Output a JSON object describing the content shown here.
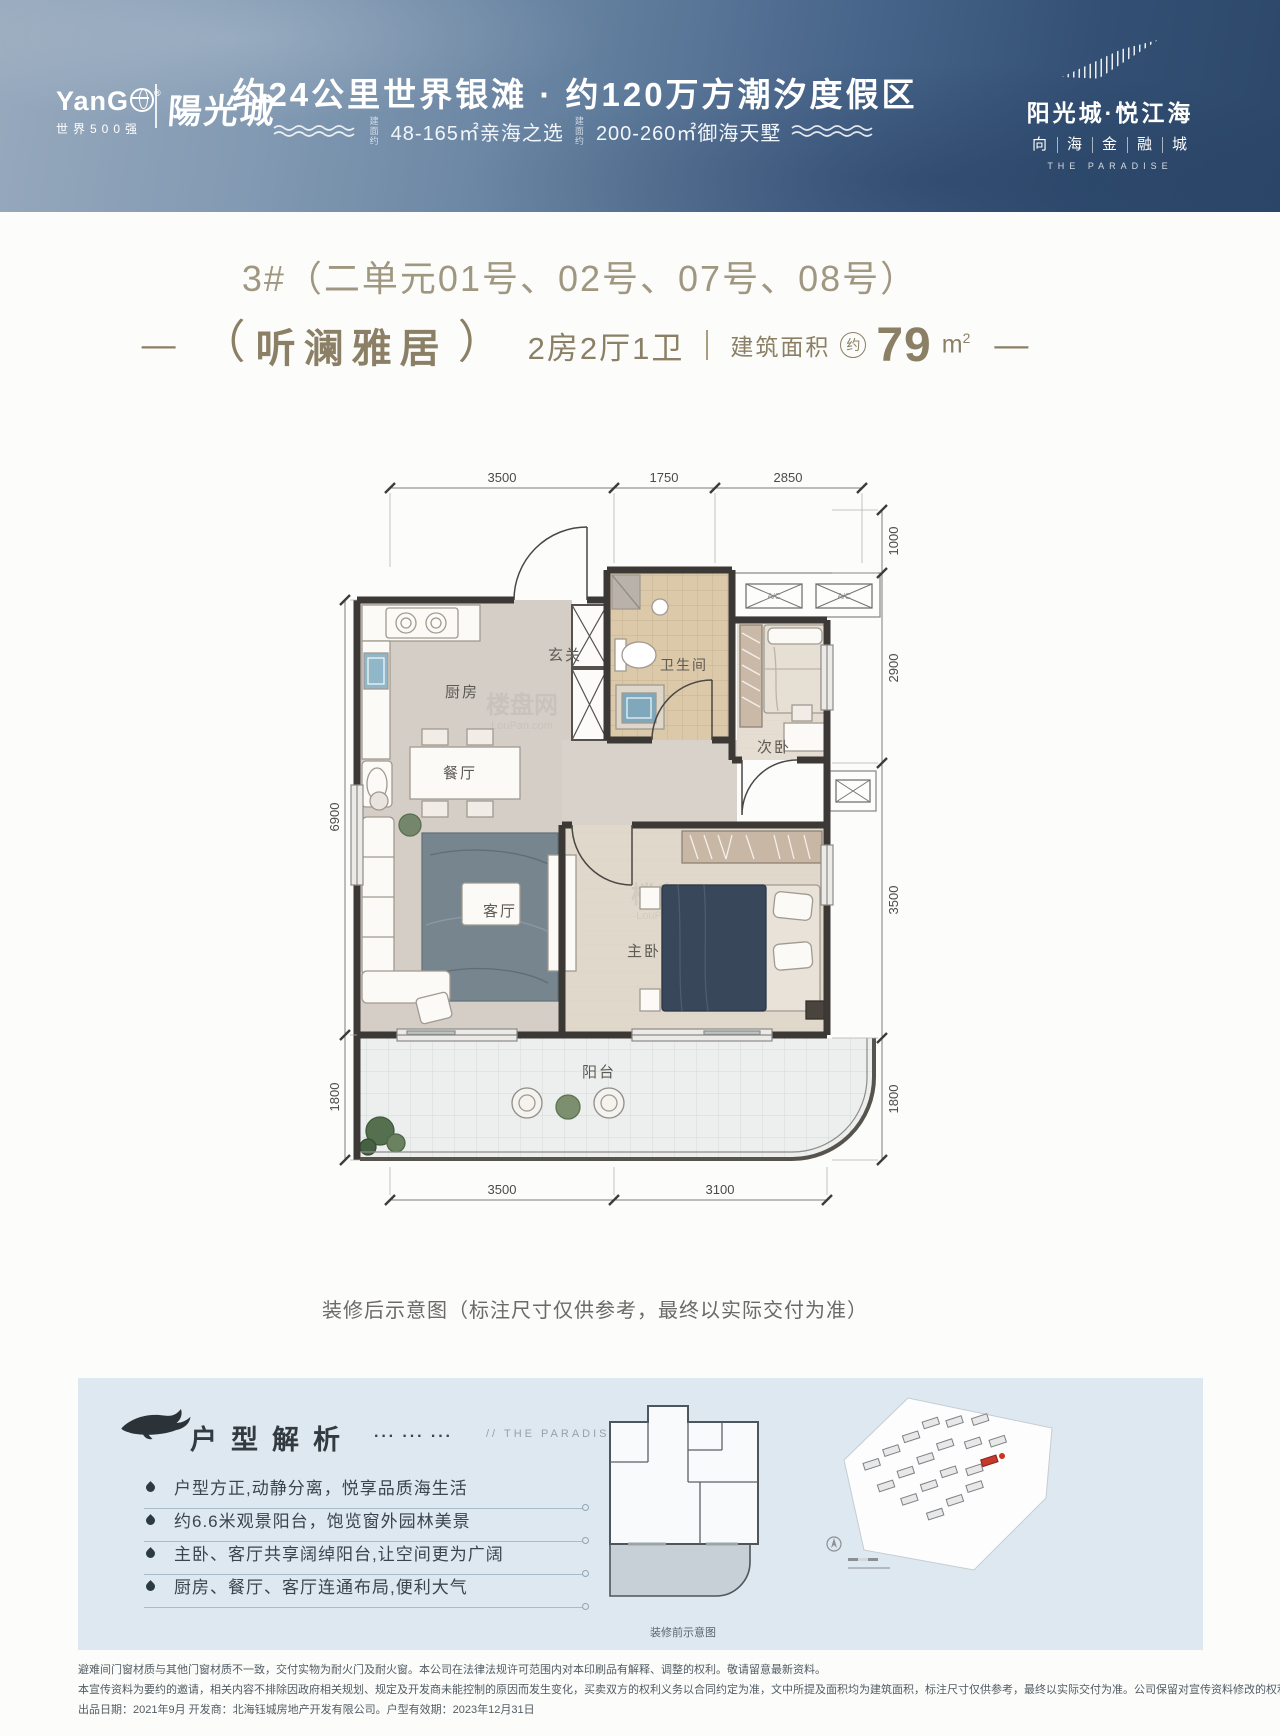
{
  "header": {
    "brand": {
      "name_head": "YanG",
      "reg": "®",
      "tagline": "世界500强",
      "brand_cn": "陽光城"
    },
    "headline": "约24公里世界银滩 · 约120万方潮汐度假区",
    "offers": [
      {
        "prefix": "建面约",
        "text": "48-165㎡亲海之选"
      },
      {
        "prefix": "建面约",
        "text": "200-260㎡御海天墅"
      }
    ],
    "project": {
      "name": "阳光城·悦江海",
      "chars": [
        "向",
        "海",
        "金",
        "融",
        "城"
      ],
      "en": "THE PARADISE"
    }
  },
  "unit": {
    "building_title": "3#（二单元01号、02号、07号、08号）",
    "dash": "—",
    "paren_open": "（",
    "paren_close": "）",
    "name": "听澜雅居",
    "layout": "2房2厅1卫",
    "area_label": "建筑面积",
    "area_approx": "约",
    "area_value": "79",
    "area_unit": "m",
    "area_sup": "2"
  },
  "floorplan": {
    "rooms": {
      "kitchen": "厨房",
      "entry": "玄关",
      "bath": "卫生间",
      "bed2": "次卧",
      "dining": "餐厅",
      "living": "客厅",
      "master": "主卧",
      "balcony": "阳台"
    },
    "dims": {
      "top": [
        "3500",
        "1750",
        "2850"
      ],
      "left": [
        "6900",
        "1800"
      ],
      "right": [
        "1000",
        "2900",
        "3500",
        "1800"
      ],
      "bottom": [
        "3500",
        "3100"
      ]
    },
    "ac_label": "A/C",
    "watermark_cn": "楼盘网",
    "watermark_en": "LouPan.com",
    "caption": "装修后示意图（标注尺寸仅供参考，最终以实际交付为准）"
  },
  "analysis": {
    "title": "户型解析",
    "dots": "··· ··· ···",
    "note": "//  THE PARADISE  /",
    "bullets": [
      "户型方正,动静分离，悦享品质海生活",
      "约6.6米观景阳台，饱览窗外园林美景",
      "主卧、客厅共享阔绰阳台,让空间更为广阔",
      "厨房、餐厅、客厅连通布局,便利大气"
    ],
    "before_caption": "装修前示意图"
  },
  "legal": {
    "lines": [
      "避难间门窗材质与其他门窗材质不一致，交付实物为耐火门及耐火窗。本公司在法律法规许可范围内对本印刷品有解释、调整的权利。敬请留意最新资料。",
      "本宣传资料为要约的邀请，相关内容不排除因政府相关规划、规定及开发商未能控制的原因而发生变化，买卖双方的权利义务以合同约定为准，文中所提及面积均为建筑面积，标注尺寸仅供参考，最终以实际交付为准。公司保留对宣传资料修改的权利。",
      "出品日期：2021年9月 开发商：北海钰城房地产开发有限公司。户型有效期：2023年12月31日"
    ]
  }
}
